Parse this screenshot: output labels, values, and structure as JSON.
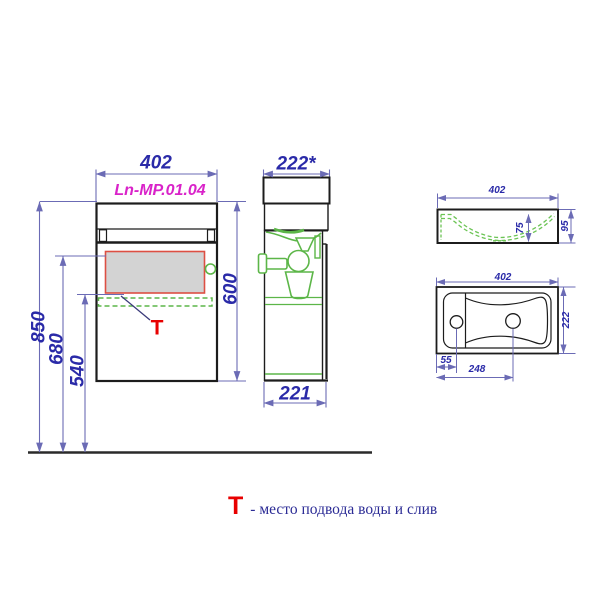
{
  "drawing": {
    "front_view": {
      "model_label": "Ln-MP.01.04",
      "width_mm": "402",
      "height_mm": "600",
      "mount_height_mm": "850",
      "supply_zone_top_mm": "680",
      "supply_zone_bottom_mm": "540",
      "t_marker": "Т"
    },
    "side_view": {
      "depth_top_mm": "222*",
      "depth_bottom_mm": "221"
    },
    "sink_front_section": {
      "width_mm": "402",
      "bowl_depth_mm": "75",
      "height_mm": "95"
    },
    "sink_plan": {
      "width_mm": "402",
      "depth_mm": "222",
      "tap_hole_offset_mm": "55",
      "drain_offset_mm": "248"
    },
    "legend": {
      "symbol": "Т",
      "text": "- место подвода воды и слив"
    },
    "colors": {
      "dimension_text_blue": "#2a2aa8",
      "dimension_line_blue": "#6b6bb5",
      "model_magenta": "#d923c9",
      "marker_red": "#e80000",
      "zone_border_red": "#dd4f43",
      "zone_fill_gray": "#d3d3d3",
      "plumbing_green": "#5cb648",
      "outline_black": "#1c1c1c",
      "legend_navy": "#2c2c96"
    }
  }
}
